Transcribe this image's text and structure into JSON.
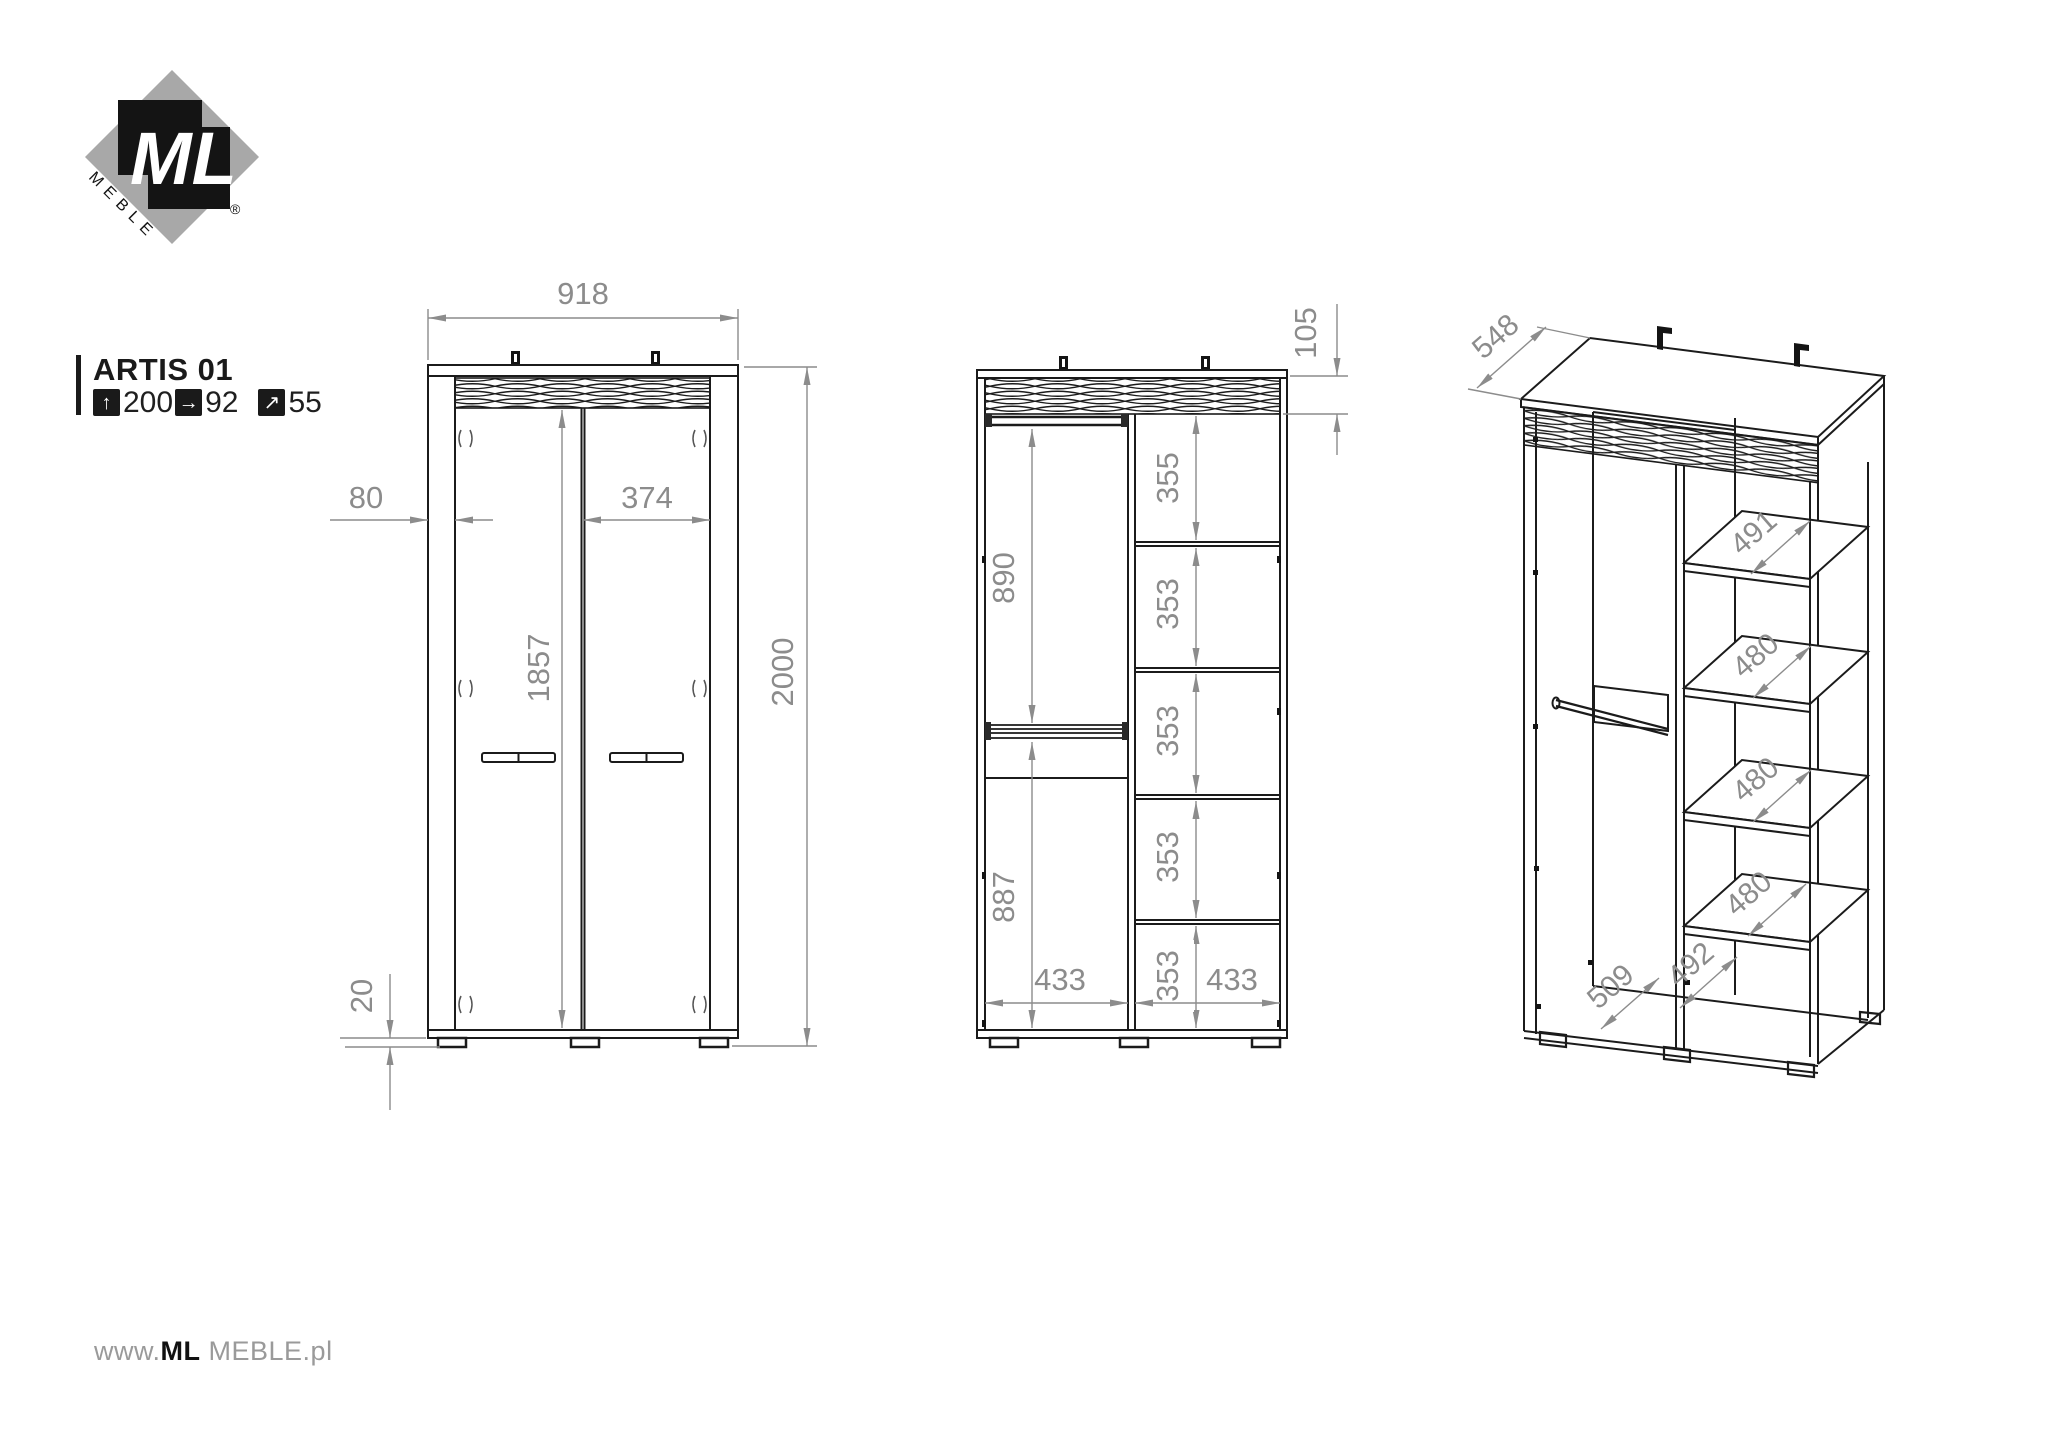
{
  "brand": {
    "logo_monogram": "ML",
    "logo_word": "MEBLE",
    "registered": "®"
  },
  "product": {
    "name": "ARTIS 01",
    "height_cm": "200",
    "width_cm": "92",
    "depth_cm": "55"
  },
  "icons": {
    "up_arrow": "↑",
    "right_arrow": "→",
    "diag_arrow": "↗"
  },
  "footer": {
    "prefix": "www.",
    "brand_bold": "ML",
    "brand_rest": " MEBLE",
    "suffix": ".pl"
  },
  "colors": {
    "line": "#1b1b1b",
    "dimension": "#8c8c8c",
    "logo_gray": "#a8a8a8"
  },
  "front_view": {
    "width": "918",
    "total_height": "2000",
    "side_offset": "80",
    "door_width": "374",
    "door_height": "1857",
    "plinth_height": "20"
  },
  "internal_view": {
    "crown_height": "105",
    "upper_section": "890",
    "lower_section": "887",
    "left_col_width": "433",
    "right_col_width": "433",
    "right_sections": [
      "355",
      "353",
      "353",
      "353",
      "353"
    ]
  },
  "iso_view": {
    "depth": "548",
    "shelf_depths": [
      "491",
      "480",
      "480",
      "480"
    ],
    "bottom_right_depth": "492",
    "bottom_left_depth": "509"
  }
}
